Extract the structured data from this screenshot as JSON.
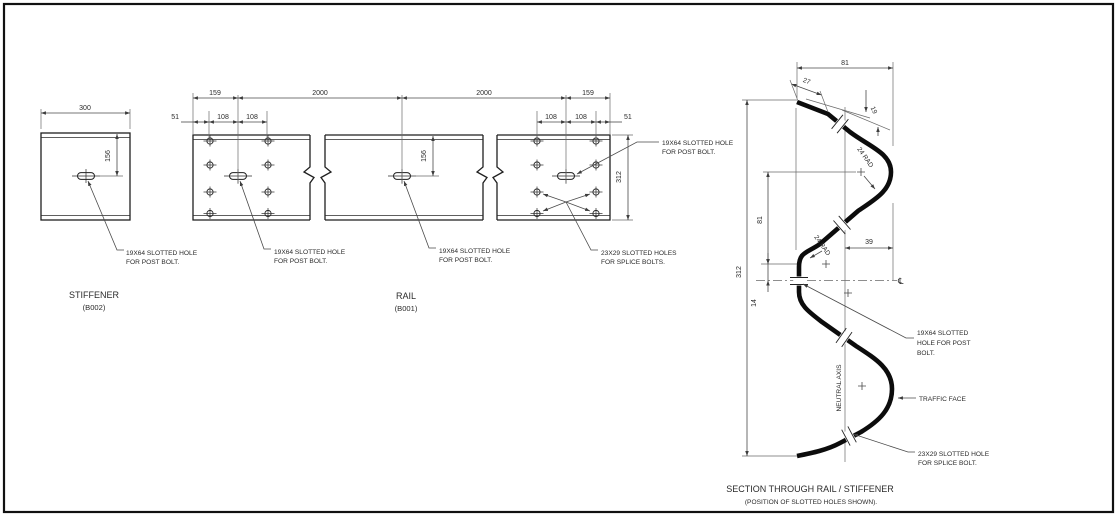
{
  "colors": {
    "background": "#ffffff",
    "line": "#1f1f1f",
    "dim_line": "#4a4a4a",
    "text": "#2b2b2b"
  },
  "stiffener_view": {
    "title": "STIFFENER",
    "part_no": "(B002)",
    "dims": {
      "width": "300",
      "slot_offset": "156"
    },
    "note": {
      "line1": "19X64 SLOTTED HOLE",
      "line2": "FOR POST BOLT."
    }
  },
  "rail_view": {
    "title": "RAIL",
    "part_no": "(B001)",
    "dims": {
      "top": [
        "159",
        "2000",
        "2000",
        "159"
      ],
      "sub_left": [
        "51",
        "108",
        "108"
      ],
      "sub_right": [
        "108",
        "108",
        "51"
      ],
      "slot_offset": "156",
      "height": "312"
    },
    "notes": {
      "post_left": {
        "line1": "19X64 SLOTTED HOLE",
        "line2": "FOR POST BOLT."
      },
      "post_mid": {
        "line1": "19X64 SLOTTED HOLE",
        "line2": "FOR POST BOLT."
      },
      "post_right": {
        "line1": "19X64 SLOTTED HOLE",
        "line2": "FOR POST BOLT."
      },
      "splice": {
        "line1": "23X29 SLOTTED HOLES",
        "line2": "FOR SPLICE BOLTS."
      }
    }
  },
  "section_view": {
    "title": "SECTION THROUGH RAIL / STIFFENER",
    "subtitle": "(POSITION OF SLOTTED HOLES SHOWN).",
    "dims": {
      "overall_width": "81",
      "lip": "27",
      "lip_offset": "19",
      "radius_top": "24 RAD",
      "radius_valley": "24 RAD",
      "crest_to_valley": "81",
      "valley_to_axis": "14",
      "axis_offset": "39",
      "overall_height": "312"
    },
    "labels": {
      "neutral_axis": "NEUTRAL AXIS",
      "centreline_symbol": "℄",
      "traffic_face": "TRAFFIC FACE"
    },
    "notes": {
      "post": {
        "line1": "19X64 SLOTTED",
        "line2": "HOLE FOR POST",
        "line3": "BOLT."
      },
      "splice": {
        "line1": "23X29 SLOTTED HOLE",
        "line2": "FOR SPLICE BOLT."
      }
    }
  }
}
